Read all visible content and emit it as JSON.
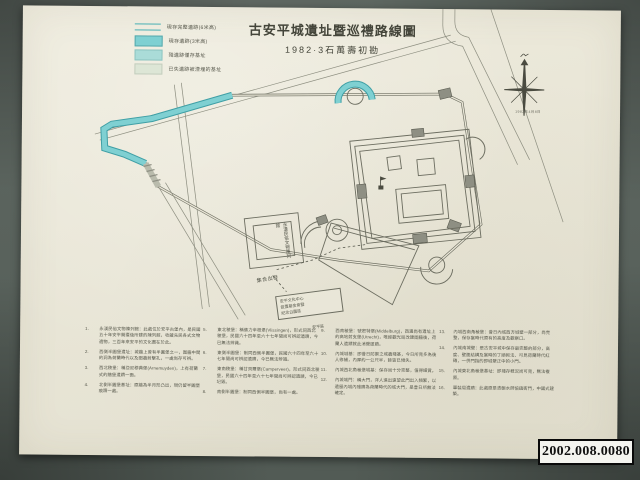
{
  "photo": {
    "backdrop_color": "#5c655f",
    "paper_color": "#e9e6d7",
    "catalog_number": "2002.008.0080"
  },
  "map": {
    "title": "古安平城遺址暨巡禮路線圖",
    "subtitle": "1982·3石萬壽初勘",
    "accent_color": "#7fd0d2",
    "line_color": "#6c6d60",
    "compass": {
      "icon": "compass-rose-icon",
      "date_note": "1982年4月8日"
    },
    "legend": {
      "items": [
        {
          "label": "現存完整遺跡(6米高)",
          "style": "line-thin",
          "color": "#49b0b4"
        },
        {
          "label": "現存遺跡(3米高)",
          "style": "bar-solid",
          "color": "#7fd0d2"
        },
        {
          "label": "殘遺跡僅存基址",
          "style": "bar-light",
          "color": "#aadcd8"
        },
        {
          "label": "已失遺跡被湮埋的基址",
          "style": "bar-pale",
          "color": "#dde6d6"
        }
      ]
    },
    "labels": {
      "museum": "永漢民俗文物陳列館",
      "assembly_point": "集合出發",
      "note_box_lines": [
        "安平文化中心",
        "設置基金會暨",
        "紀念公園區"
      ],
      "note_box_caption": "安平區"
    },
    "notes": {
      "columns": [
        [
          {
            "n": "1",
            "text": "永漢民俗文物陳列館：此處位於安平古堡內，是民國五十年安平開臺後所建的陳列館，收藏先民各式文物遺物，三百年來安平的文化盡在於此。"
          },
          {
            "n": "2",
            "text": "西側半圓堡遺址：城牆上曾有半圓堡之一，圍牆中間的洞為荷蘭時代以及圍牆射擊孔，一處尚存可辨。"
          },
          {
            "n": "3",
            "text": "西北稜堡：稱亞尼穆典堡(Arnemuyden)，上有荷蘭式的牆堡遺蹟一面。"
          },
          {
            "n": "4",
            "text": "北側半圓堡基址：原牆為半月形凸出，現仍留半圓堡痕蹟一處。"
          }
        ],
        [
          {
            "n": "5",
            "text": "東北稜堡：稱佛力辛根堡(Vlissingen)，形式同西北稜堡，民國六十四年至六十七年間尚可辨認遺蹟，今已無法辨識。"
          },
          {
            "n": "6",
            "text": "東側半圓堡：制同西側半圓堡，民國六十四年至六十七年間尚可辨認遺蹟，今已無法辨識。"
          },
          {
            "n": "7",
            "text": "東南稜堡：稱甘貝爾堡(Camperveer)，形式同西北稜堡，民國六十四年至六十七年間尚可辨認遺蹟，今已圮毀。"
          },
          {
            "n": "8",
            "text": "南側半圓堡：制同西側半圓堡，尚有一處。"
          }
        ],
        [
          {
            "n": "9",
            "text": "西南稜堡：號密特堡(Middelburg)，西邊尚有遺址上的高地射支堡(Utrecht)，唯經觀光局改建圍牆後，荷蘭人遺蹟就此消聲匿蹟。"
          },
          {
            "n": "10",
            "text": "內城城基：即昔日防禦之城牆殘基，今日所見多為後人修補，內厚約一公尺半，餘皆已傾失。"
          },
          {
            "n": "11",
            "text": "內城西北角稜堡城基：保存尚十分完整，值得細賞。"
          },
          {
            "n": "12",
            "text": "內城城門：稱大門，洋人進出遠望此門出入頻繁，以遺留內城內殘蹟為荷蘭時代的城大門，是昔日所無法確定。"
          }
        ],
        [
          {
            "n": "13",
            "text": "內城西南角稜堡：昔日內城西方城壁一部分，尚完整，保存當時代原有的高度及觀察口。"
          },
          {
            "n": "14",
            "text": "內城南城壁：是古安平城中保存最完整的部分，高度、壁面結構及當時的丁順砌法、可見荷蘭時代紅磚，一併門指的即城壁正中的小門。"
          },
          {
            "n": "15",
            "text": "內城東北角稜堡基址：即殘存概況尚可見，無法複原。"
          },
          {
            "n": "16",
            "text": "軍裝局遺蹟：此處原是清朝水師協鎮衙門，中國式建築。"
          }
        ]
      ]
    }
  }
}
